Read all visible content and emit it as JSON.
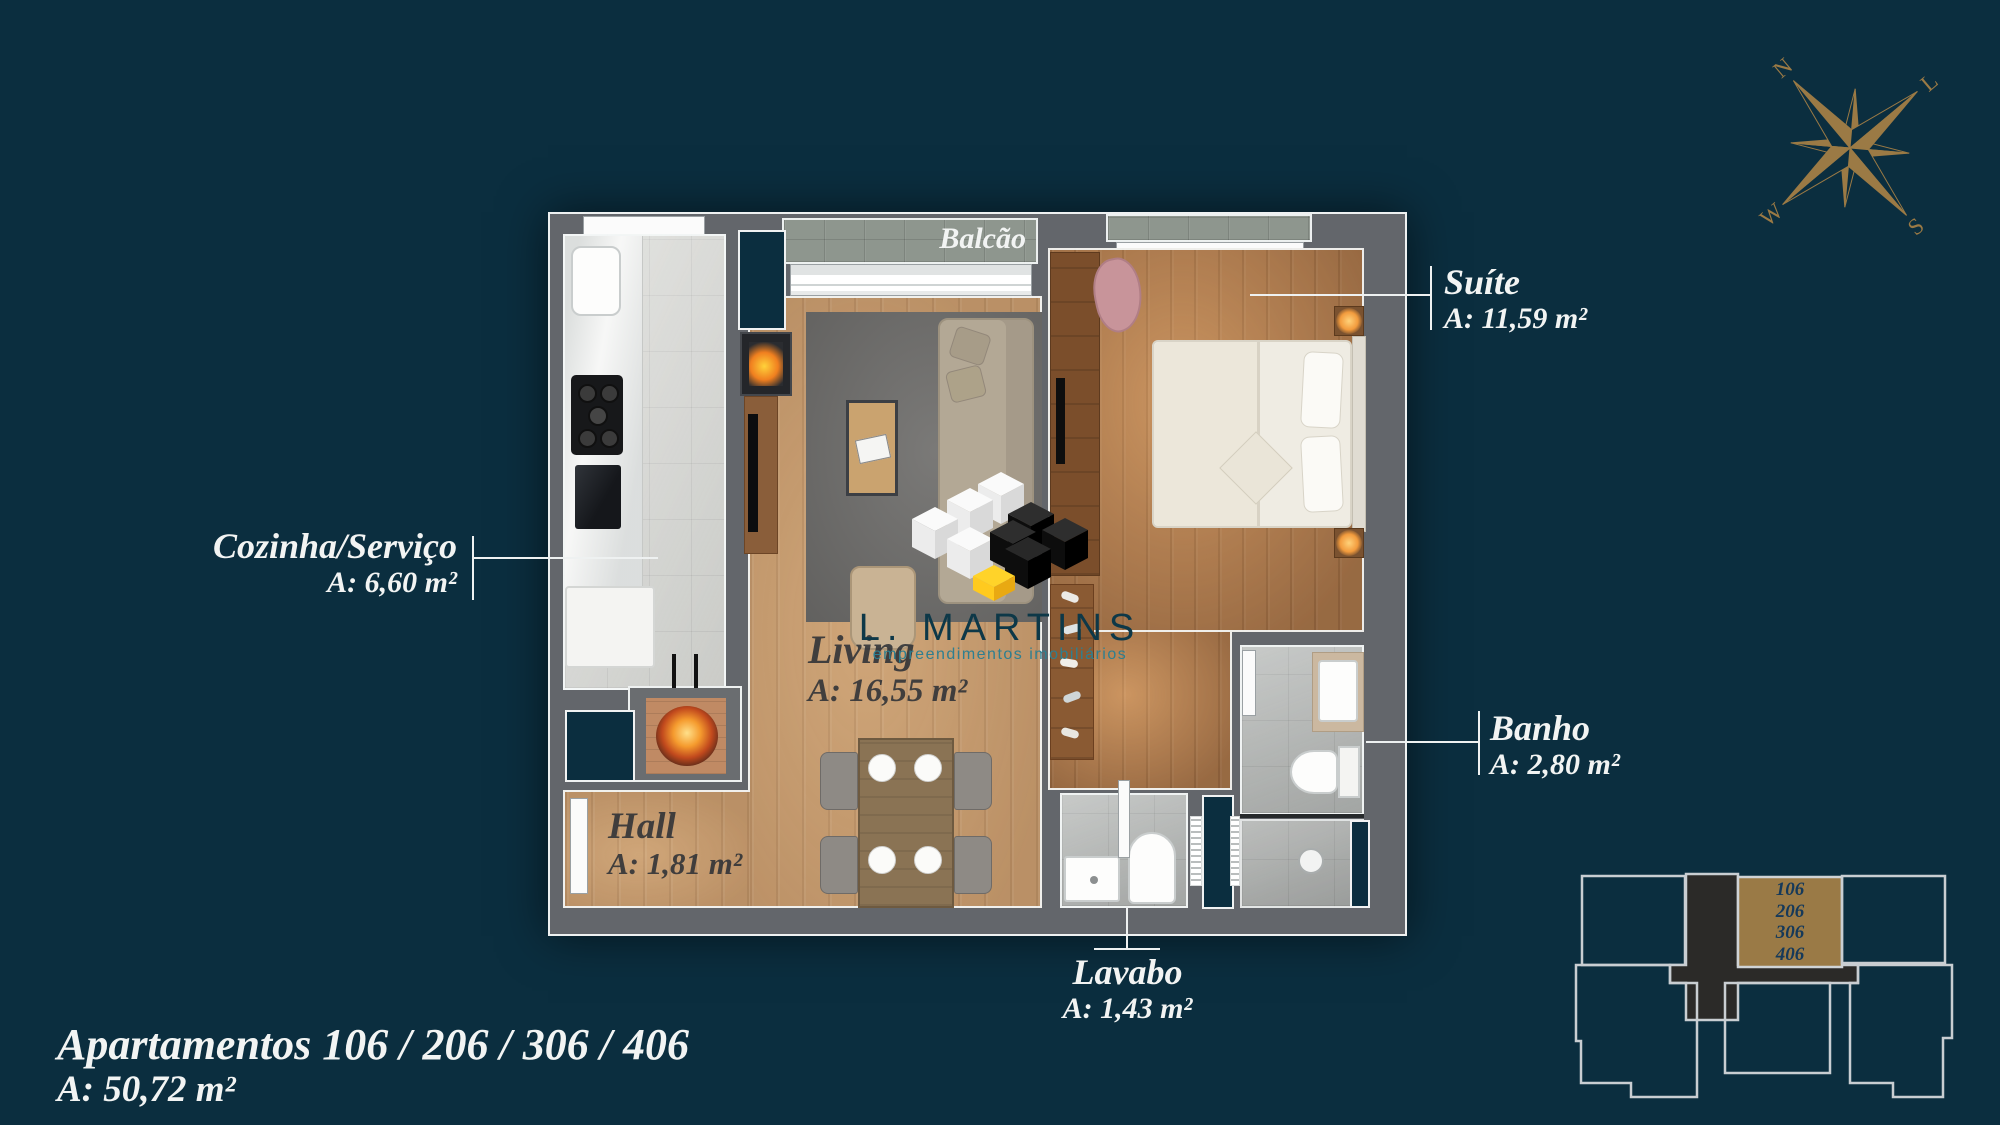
{
  "title": {
    "line1": "Apartamentos 106 / 206 / 306 / 406",
    "line2": "A: 50,72 m²"
  },
  "compass": {
    "north": "N",
    "east": "L",
    "south": "S",
    "west": "W"
  },
  "logo": {
    "name": "L. MARTINS",
    "tagline": "empreendimentos imobiliários"
  },
  "rooms": {
    "balcao": {
      "name": "Balcão"
    },
    "suite": {
      "name": "Suíte",
      "area": "A: 11,59 m²"
    },
    "cozinha": {
      "name": "Cozinha/Serviço",
      "area": "A: 6,60 m²"
    },
    "living": {
      "name": "Living",
      "area": "A: 16,55 m²"
    },
    "banho": {
      "name": "Banho",
      "area": "A: 2,80 m²"
    },
    "hall": {
      "name": "Hall",
      "area": "A: 1,81 m²"
    },
    "lavabo": {
      "name": "Lavabo",
      "area": "A: 1,43 m²"
    }
  },
  "keyplan": {
    "units": [
      "106",
      "206",
      "306",
      "406"
    ]
  },
  "colors": {
    "background": "#0b2e3f",
    "accent_gold": "#9a7a46",
    "wall_gray": "#63666b",
    "wood_light": "#c59a6e",
    "wood_dark": "#b07c4f",
    "tile_light": "#d7d8d4",
    "tile_gray": "#b5b8b6",
    "stone": "#8e968e",
    "label_light": "#f2f4f3",
    "label_dark": "#343a42",
    "logo_teal": "#0d3848",
    "keyplan_number": "#15395a"
  }
}
